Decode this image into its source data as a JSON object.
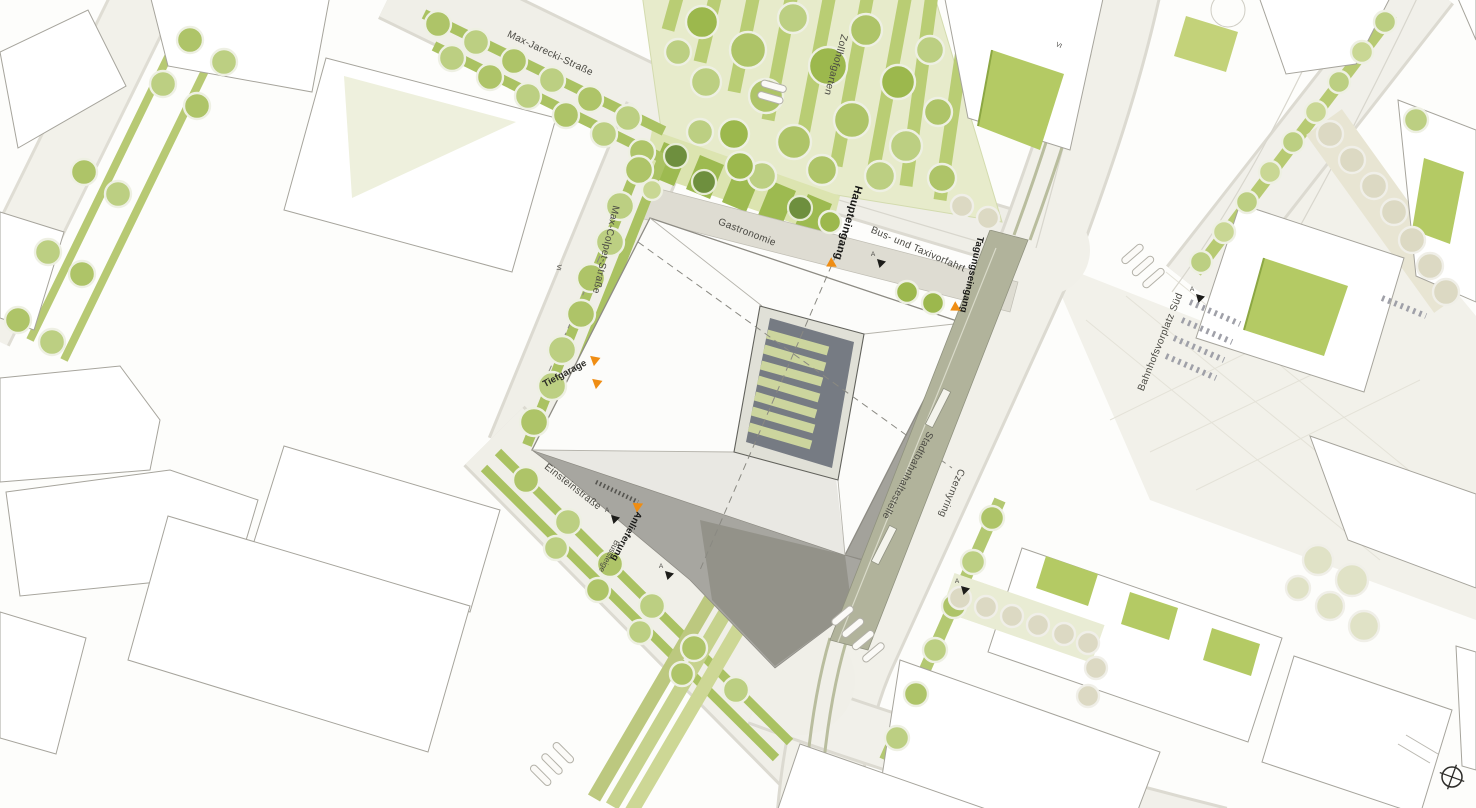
{
  "labels": {
    "max_jarecki": "Max-Jarecki-Straße",
    "zollhofgarten": "Zollhofgarten",
    "max_colpet": "Max-Colpet-Straße",
    "tiefgarage": "Tiefgarage",
    "einsteinstrasse": "Einsteinstraße",
    "anlieferung": "Anlieferung",
    "bussteige": "Bussteige",
    "gastronomie": "Gastronomie",
    "haupteingang": "Haupteingang",
    "bus_und_taxivorfahrt": "Bus- und Taxivorfahrt",
    "tagungseingang": "Tagungseingang",
    "stadtbahnhaltestelle": "Stadtbahnhaltestelle",
    "czernyring": "Czernyring",
    "bahnhofsvorplatz_sued": "Bahnhofsvorplatz Süd"
  },
  "markers": {
    "section_letter": "A",
    "storeys_main": "VI"
  },
  "colors": {
    "accent_orange": "#EF8D13",
    "tree_green": "#A9C161",
    "park_green": "#E7EBCB",
    "street_gray": "#EFEEE7",
    "facade_gray": "#A7A6A0",
    "label_dark": "#4A4944"
  }
}
